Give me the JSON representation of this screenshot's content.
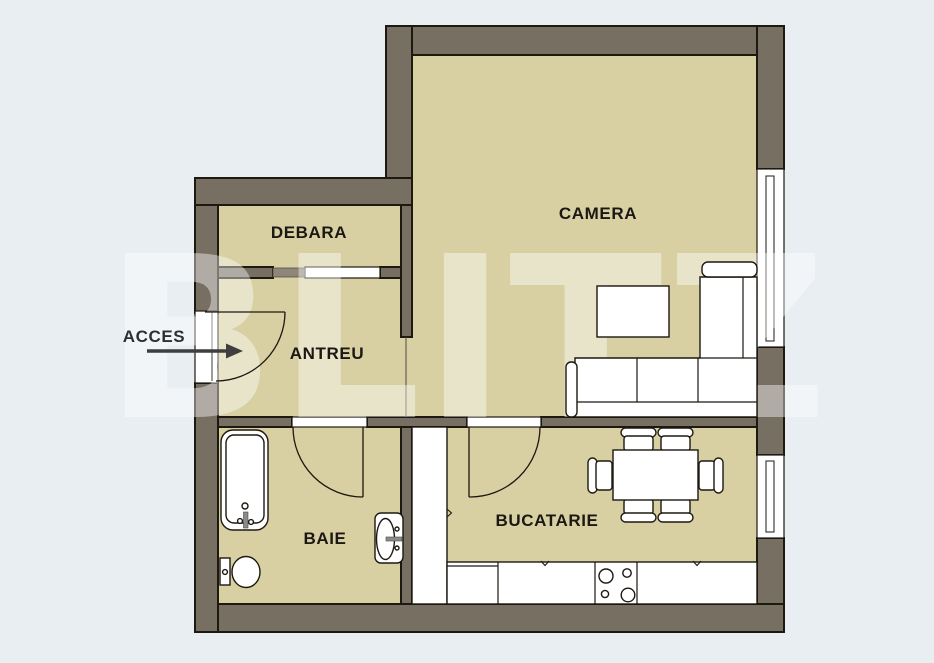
{
  "watermark": {
    "text": "BLITZ"
  },
  "rooms": {
    "debara": {
      "label": "DEBARA"
    },
    "camera": {
      "label": "CAMERA"
    },
    "antreu": {
      "label": "ANTREU"
    },
    "baie": {
      "label": "BAIE"
    },
    "bucatarie": {
      "label": "BUCATARIE"
    }
  },
  "entrance": {
    "label": "ACCES"
  },
  "colors": {
    "background": "#e9eef3",
    "wall": "#786f63",
    "floor": "#d8d0a2",
    "outline": "#1d1810",
    "sliding_panel": "#8e8678",
    "arrow": "#3e3e3e",
    "watermark": "rgba(255,255,255,0.42)"
  }
}
